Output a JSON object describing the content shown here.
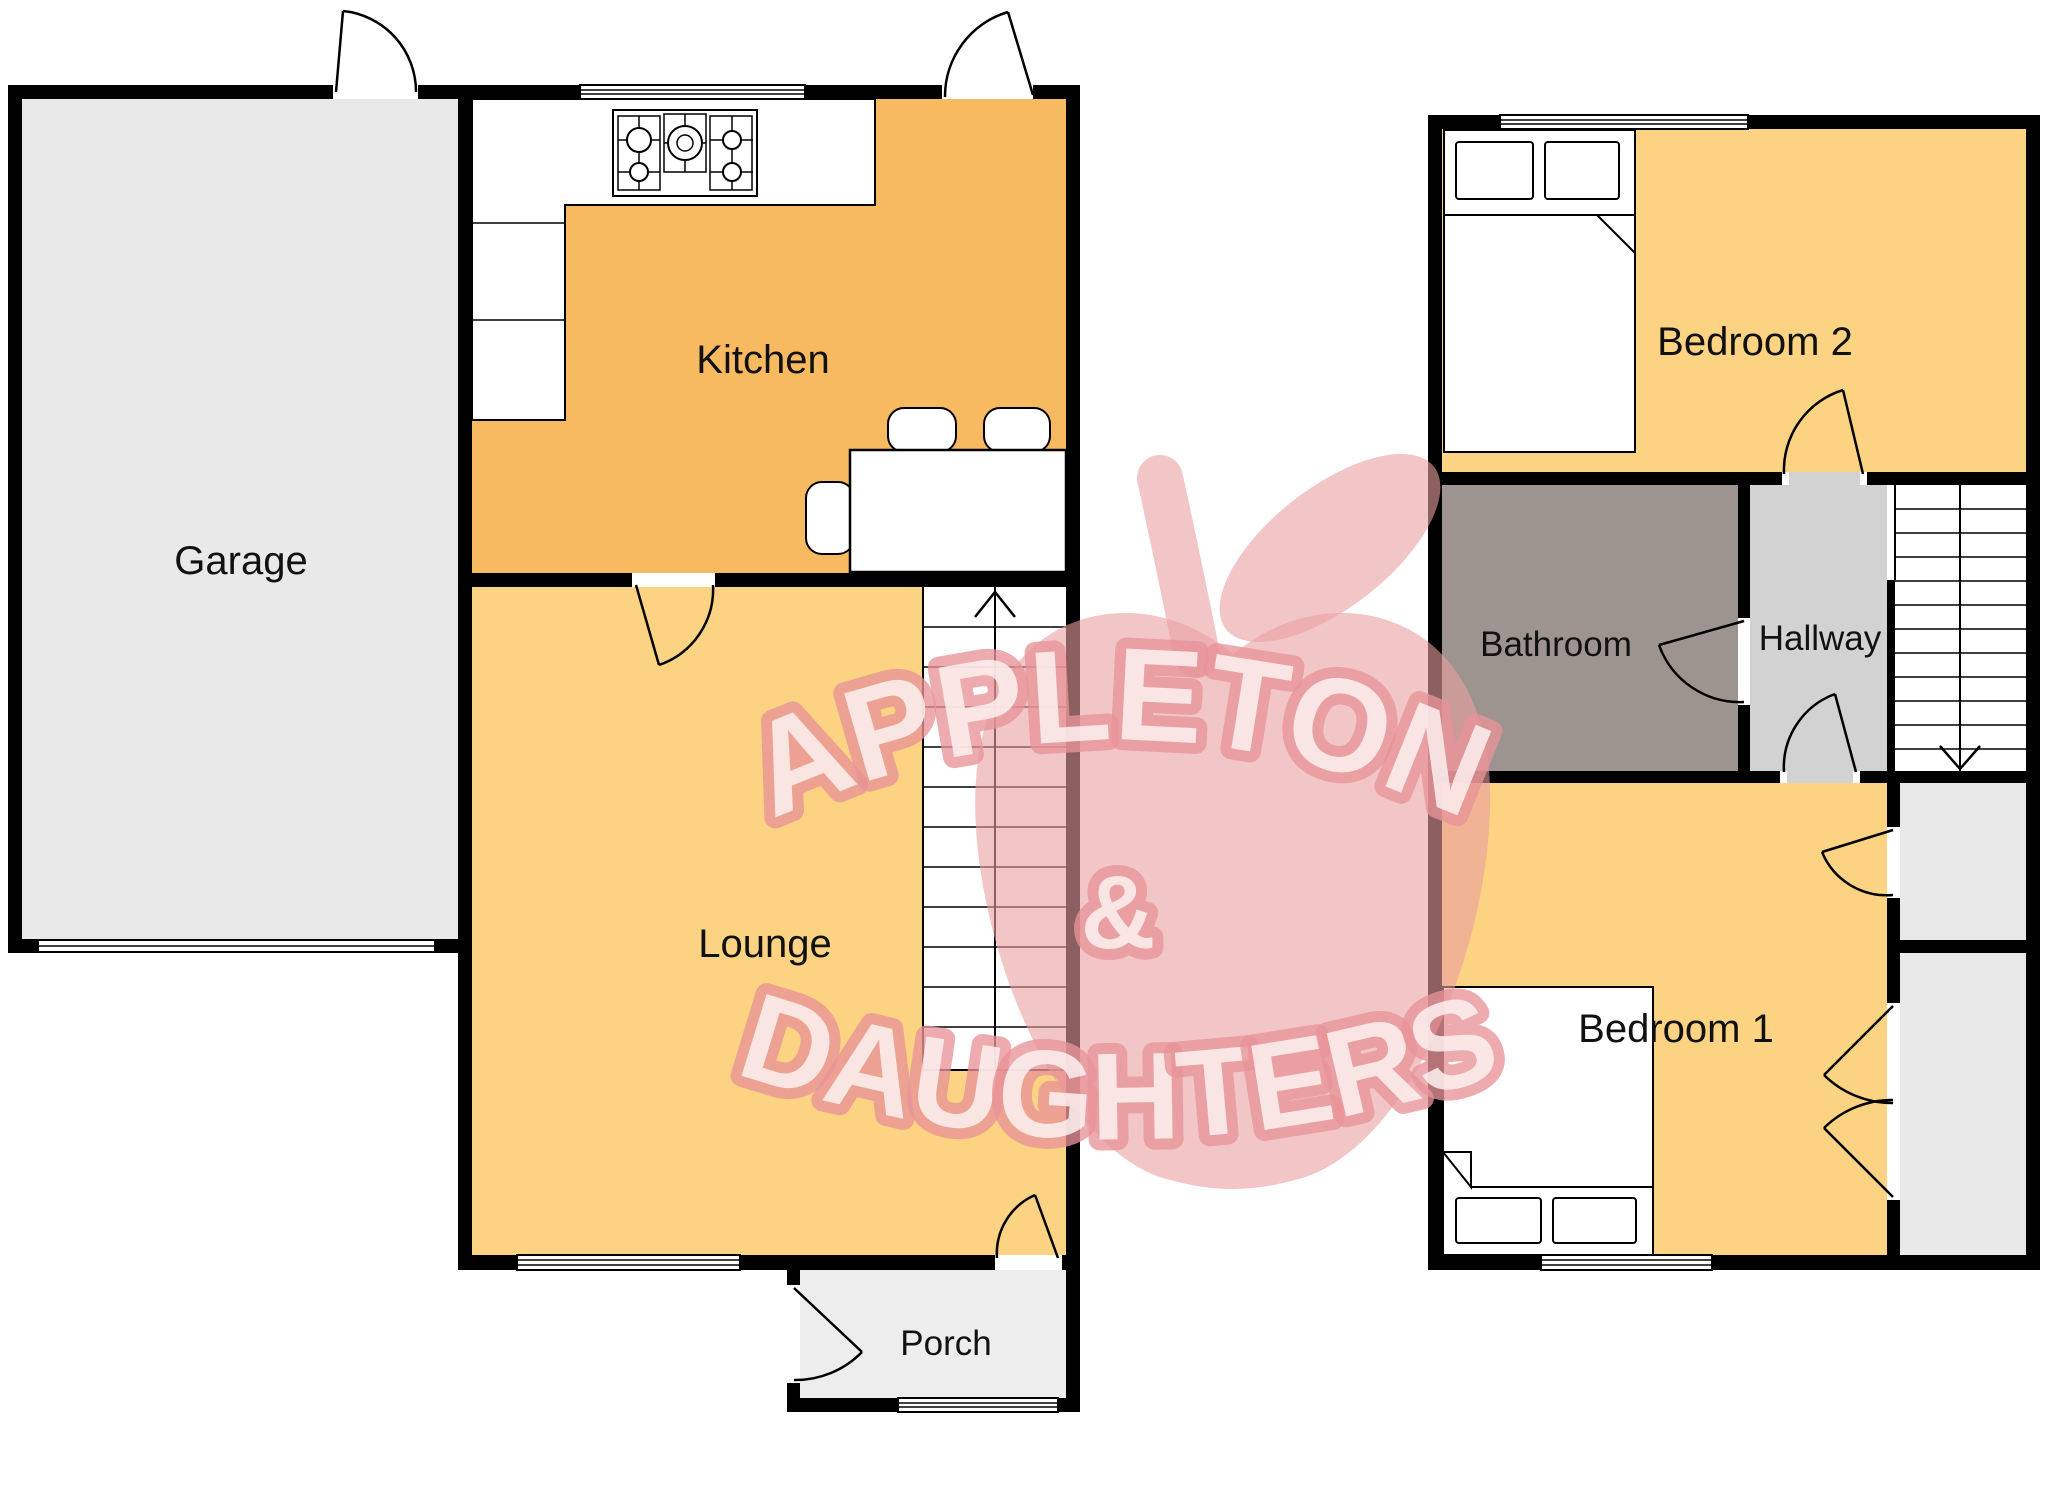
{
  "document": {
    "type": "estate-agent-floorplan",
    "floors": {
      "ground": {
        "rooms": {
          "garage": {
            "label": "Garage"
          },
          "kitchen": {
            "label": "Kitchen"
          },
          "lounge": {
            "label": "Lounge"
          },
          "porch": {
            "label": "Porch"
          }
        },
        "stairs_direction_icon": "arrow-up"
      },
      "first": {
        "rooms": {
          "bedroom2": {
            "label": "Bedroom 2"
          },
          "bathroom": {
            "label": "Bathroom"
          },
          "hallway": {
            "label": "Hallway"
          },
          "bedroom1": {
            "label": "Bedroom 1"
          }
        },
        "stairs_direction_icon": "arrow-down"
      }
    }
  },
  "watermark": {
    "line1": "APPLETON",
    "amp": "&",
    "line2": "DAUGHTERS",
    "logo_icon": "apple-logo"
  },
  "colors": {
    "wall": "#000000",
    "kitchen_fill": "#F8BA60",
    "warm_room_fill": "#FBD382",
    "garage_fill": "#E9E9E9",
    "closet_fill": "#E9E9E9",
    "porch_fill": "#EDEDED",
    "hallway_fill": "#D2D2D2",
    "bathroom_fill": "#9D948F",
    "stairs_fill": "#FFFFFF",
    "label_text": "#111111",
    "watermark_pink": "#F2C5C6",
    "watermark_letter_fill": "#FCF1F0",
    "watermark_letter_outline": "#E9A5A9"
  }
}
